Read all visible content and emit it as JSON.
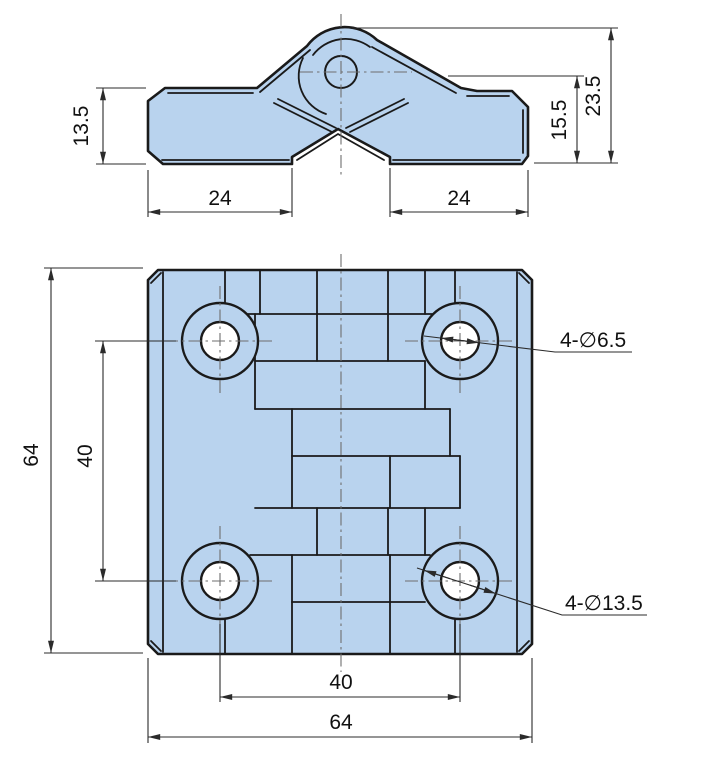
{
  "front_view": {
    "dim_left_height": "13.5",
    "dim_left_width": "24",
    "dim_right_width": "24",
    "dim_right_inner_height": "15.5",
    "dim_total_height": "23.5"
  },
  "plan_view": {
    "dim_overall_height": "64",
    "dim_hole_spacing_vertical": "40",
    "dim_hole_spacing_horizontal": "40",
    "dim_overall_width": "64",
    "callout_small_holes": "4-∅6.5",
    "callout_large_holes": "4-∅13.5"
  },
  "style": {
    "part_fill": "#b9d3ee",
    "outline_color": "#1a1a1a",
    "dimension_color": "#2b2b2b",
    "centerline_color": "#6e6e6e",
    "background": "#ffffff"
  }
}
